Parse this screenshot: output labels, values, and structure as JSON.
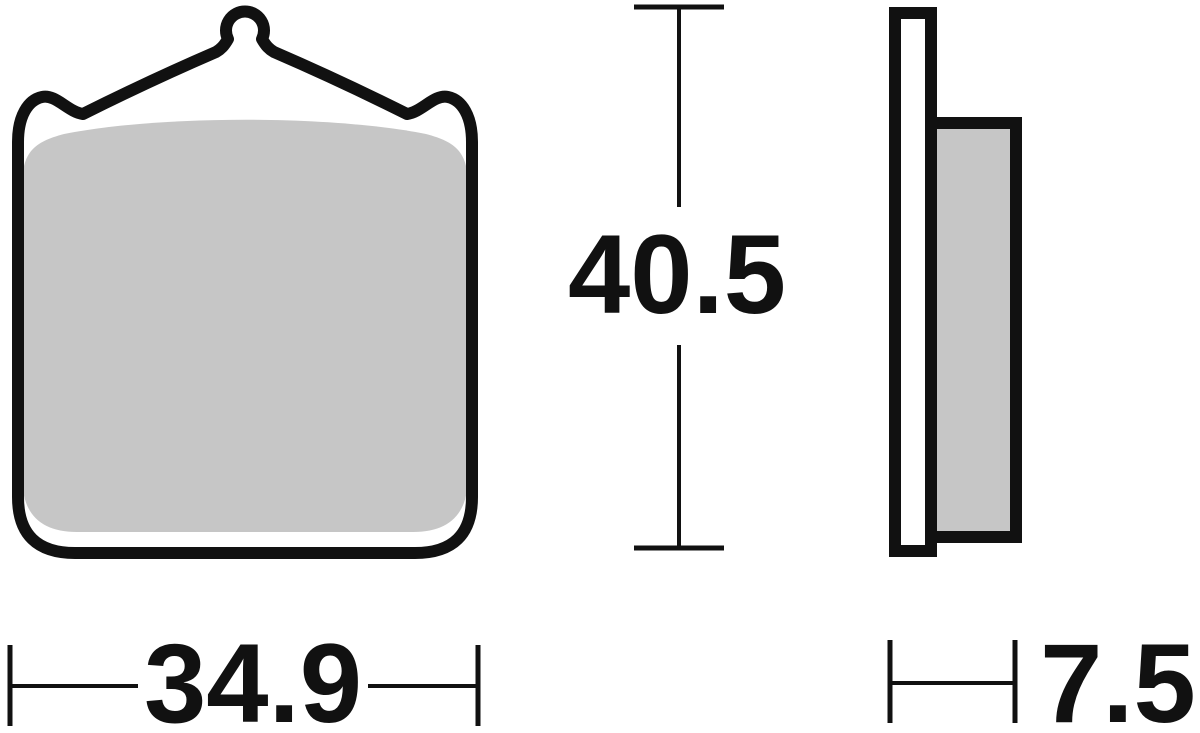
{
  "drawing": {
    "type": "brake-pad-technical-drawing"
  },
  "dimensions": {
    "height_label": "40.5",
    "width_label": "34.9",
    "thickness_label": "7.5"
  },
  "colors": {
    "outline": "#111111",
    "friction_gray": "#c6c6c6",
    "background": "#ffffff",
    "text": "#111111"
  }
}
